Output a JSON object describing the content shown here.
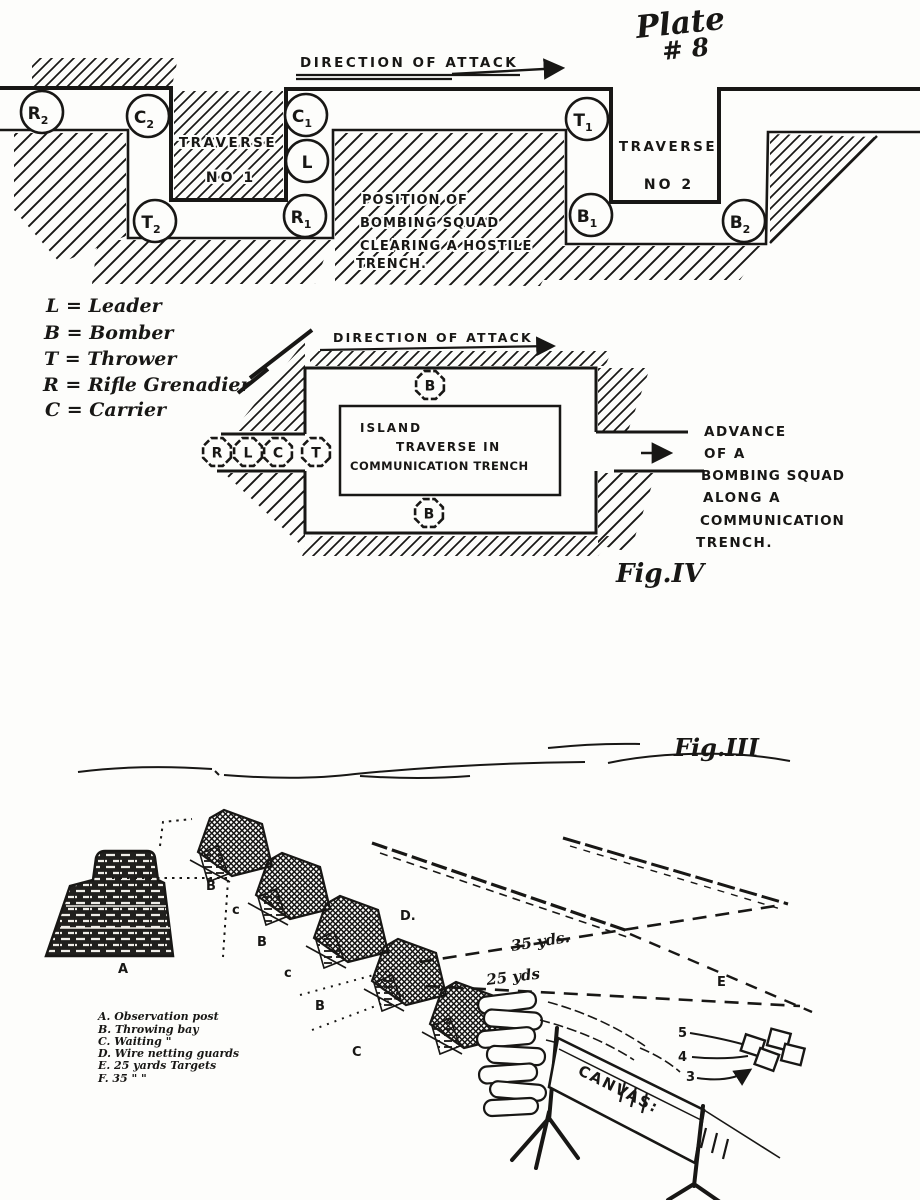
{
  "page": {
    "ink": "#181715",
    "paper": "#fdfdfb"
  },
  "plate_title": {
    "line1": "Plate",
    "line2": "# 8"
  },
  "fig_top": {
    "direction_label": "DIRECTION OF ATTACK",
    "traverse1": {
      "line1": "TRAVERSE",
      "line2": "NO 1"
    },
    "traverse2": {
      "line1": "TRAVERSE",
      "line2": "NO 2"
    },
    "position_note": [
      "POSITION OF",
      "BOMBING SQUAD",
      "CLEARING A HOSTILE",
      "TRENCH."
    ],
    "markers": [
      {
        "label": "R",
        "sub": "2",
        "x": 42,
        "y": 112
      },
      {
        "label": "C",
        "sub": "2",
        "x": 148,
        "y": 116
      },
      {
        "label": "T",
        "sub": "2",
        "x": 155,
        "y": 221
      },
      {
        "label": "C",
        "sub": "1",
        "x": 306,
        "y": 115
      },
      {
        "label": "L",
        "sub": "",
        "x": 307,
        "y": 161
      },
      {
        "label": "R",
        "sub": "1",
        "x": 305,
        "y": 216
      },
      {
        "label": "T",
        "sub": "1",
        "x": 587,
        "y": 119
      },
      {
        "label": "B",
        "sub": "1",
        "x": 591,
        "y": 215
      },
      {
        "label": "B",
        "sub": "2",
        "x": 744,
        "y": 221
      }
    ]
  },
  "legend": {
    "items": [
      "L = Leader",
      "B = Bomber",
      "T = Thrower",
      "R = Rifle Grenadier",
      "C = Carrier"
    ]
  },
  "fig4": {
    "direction_label": "DIRECTION OF ATTACK",
    "island_label": [
      "ISLAND",
      "TRAVERSE IN",
      "COMMUNICATION TRENCH"
    ],
    "advance_note": [
      "ADVANCE",
      "OF A",
      "BOMBING SQUAD",
      "ALONG A",
      "COMMUNICATION",
      "TRENCH."
    ],
    "caption": "Fig.IV",
    "markers": [
      {
        "label": "R",
        "x": 217,
        "y": 452
      },
      {
        "label": "L",
        "x": 248,
        "y": 452
      },
      {
        "label": "C",
        "x": 278,
        "y": 452
      },
      {
        "label": "T",
        "x": 316,
        "y": 452
      },
      {
        "label": "B",
        "x": 430,
        "y": 385
      },
      {
        "label": "B",
        "x": 429,
        "y": 513
      }
    ]
  },
  "fig3": {
    "caption": "Fig.III",
    "key_lines": [
      "A. Observation post",
      "B. Throwing bay",
      "C. Waiting  \"",
      "D. Wire netting guards",
      "E. 25 yards Targets",
      "F. 35   \"        \""
    ],
    "canvas_label": "CANVAS:",
    "distance_35": "35 yds.",
    "distance_25": "25 yds",
    "bay_labels": [
      {
        "t": "B",
        "x": 206,
        "y": 890
      },
      {
        "t": "c",
        "x": 232,
        "y": 914
      },
      {
        "t": "B",
        "x": 257,
        "y": 946
      },
      {
        "t": "c",
        "x": 284,
        "y": 977
      },
      {
        "t": "B",
        "x": 315,
        "y": 1010
      },
      {
        "t": "C",
        "x": 352,
        "y": 1056
      }
    ],
    "point_labels": [
      {
        "t": "A",
        "x": 118,
        "y": 973
      },
      {
        "t": "D.",
        "x": 400,
        "y": 920
      },
      {
        "t": "E",
        "x": 717,
        "y": 986
      }
    ],
    "target_numbers": [
      {
        "t": "5",
        "x": 678,
        "y": 1037
      },
      {
        "t": "4",
        "x": 678,
        "y": 1061
      },
      {
        "t": "3",
        "x": 686,
        "y": 1081
      }
    ],
    "bays": [
      {
        "x": 198,
        "y": 814
      },
      {
        "x": 256,
        "y": 857
      },
      {
        "x": 314,
        "y": 900
      },
      {
        "x": 372,
        "y": 943
      },
      {
        "x": 430,
        "y": 986
      }
    ]
  }
}
